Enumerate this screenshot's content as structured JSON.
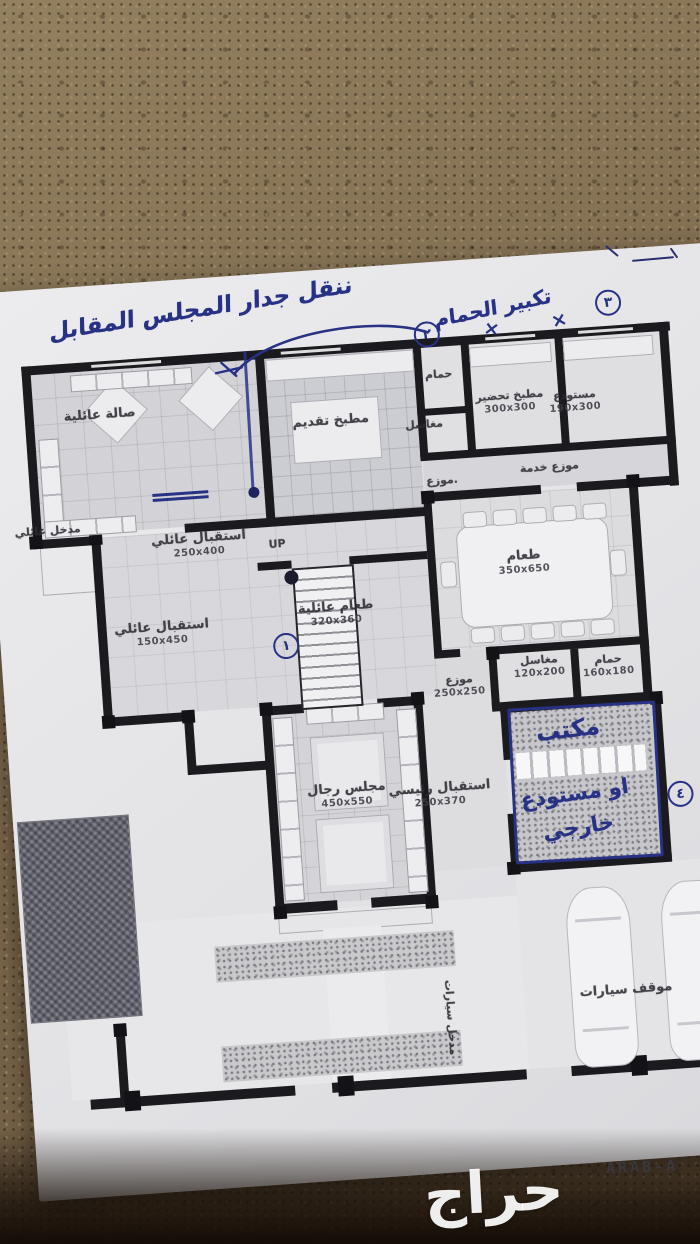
{
  "photo": {
    "watermark": "حراج",
    "stamp": "ARAB-A"
  },
  "annotations": {
    "ink_color": "#283285",
    "note_top": "ننقل جدار المجلس المقابل",
    "note_bath": "تكبير الحمام",
    "x_mark": "×",
    "circles": {
      "n1": "١",
      "n2": "٢",
      "n3": "٣",
      "n4": "٤"
    },
    "office_note": [
      "مكتب",
      "او مستودع",
      "خارجي"
    ]
  },
  "stairs": {
    "label": "UP"
  },
  "rooms": {
    "family_hall": {
      "name": "صالة عائلية",
      "dims": ""
    },
    "serving_kitchen": {
      "name": "مطبخ تقديم",
      "dims": ""
    },
    "bath_top": {
      "name": "حمام",
      "dims": ""
    },
    "sinks_top": {
      "name": "مغاسل",
      "dims": ""
    },
    "prep_kitchen": {
      "name": "مطبخ تحضير",
      "dims": "300x300"
    },
    "storage": {
      "name": "مستودع",
      "dims": "190x300"
    },
    "service_hall": {
      "name": "موزع خدمة",
      "dims": ""
    },
    "hall_small": {
      "name": ".موزع",
      "dims": ""
    },
    "family_entrance": {
      "name": "مدخل عائلي",
      "dims": ""
    },
    "family_reception1": {
      "name": "استقبال عائلي",
      "dims": "250x400"
    },
    "family_reception2": {
      "name": "استقبال عائلي",
      "dims": "150x450"
    },
    "family_dining": {
      "name": "طعام عائلية",
      "dims": "320x360"
    },
    "dining": {
      "name": "طعام",
      "dims": "350x650"
    },
    "sinks2": {
      "name": "مغاسل",
      "dims": "120x200"
    },
    "bath2": {
      "name": "حمام",
      "dims": "160x180"
    },
    "hall2": {
      "name": "موزع",
      "dims": "250x250"
    },
    "men_majlis": {
      "name": "مجلس رجال",
      "dims": "450x550"
    },
    "main_reception": {
      "name": "استقبال رئيسي",
      "dims": "250x370"
    },
    "parking": {
      "name": "موقف سيارات",
      "dims": ""
    },
    "side_entrance": {
      "name": "مدخل سيارات",
      "dims": ""
    }
  }
}
